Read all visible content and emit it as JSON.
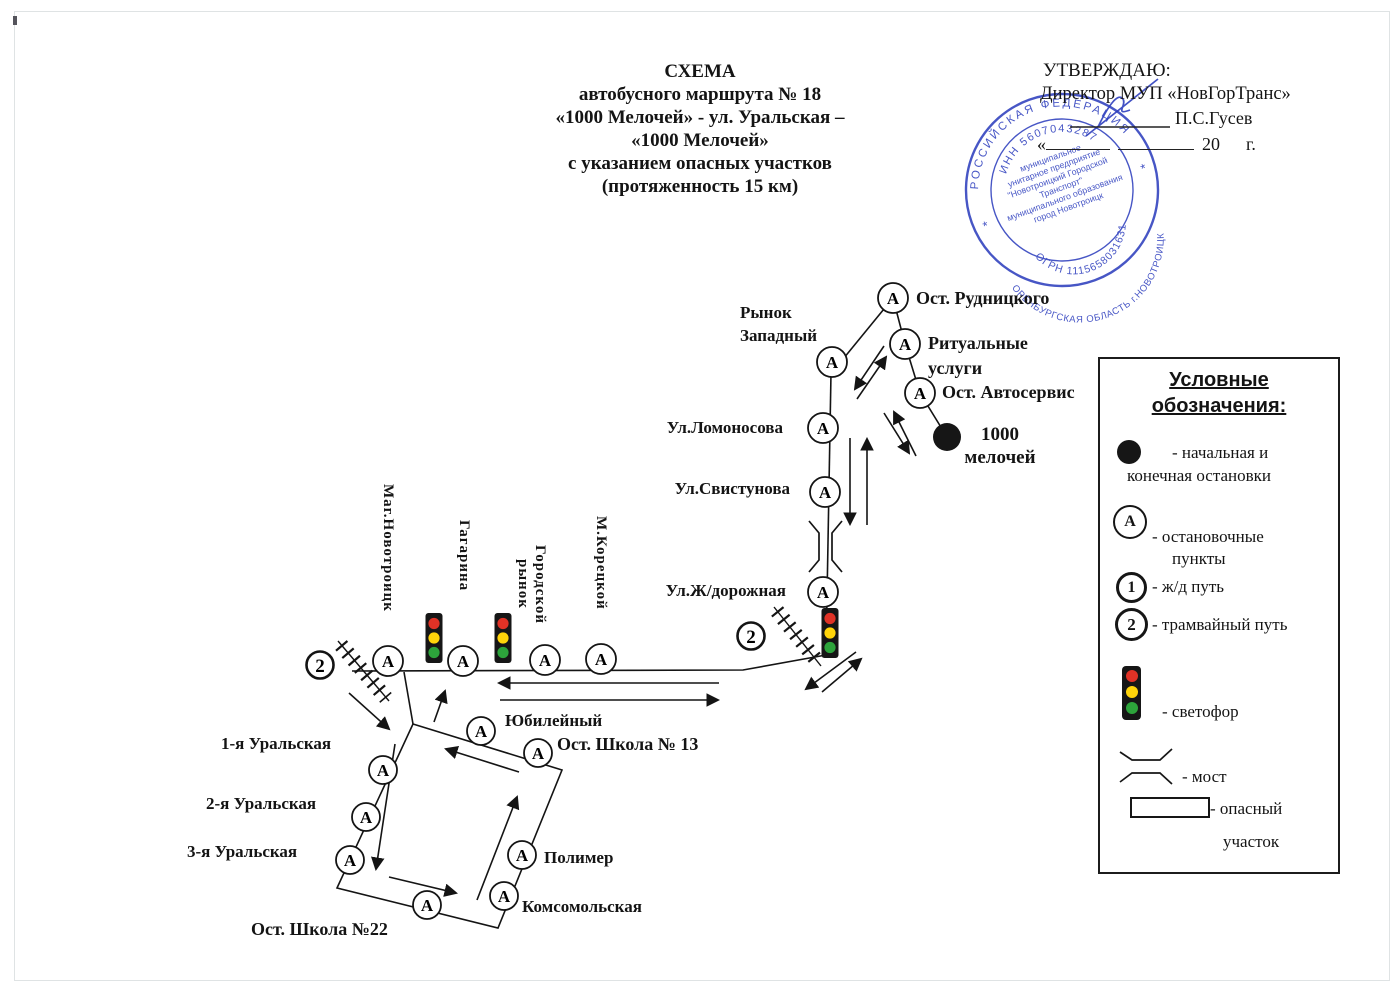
{
  "page": {
    "ink": "#141414",
    "stamp_color": "#2e3fbe"
  },
  "title": {
    "lines": [
      "СХЕМА",
      "автобусного маршрута № 18",
      "«1000 Мелочей» - ул. Уральская –",
      "«1000 Мелочей»",
      "с указанием опасных участков",
      "(протяженность 15 км)"
    ]
  },
  "approve": {
    "heading": "УТВЕРЖДАЮ:",
    "director_line": "Директор  МУП «НовГорТранс»",
    "name": "П.С.Гусев",
    "quote": "«",
    "year": "20",
    "year_unit": "г."
  },
  "stamp": {
    "top_arc": "РОССИЙСКАЯ ФЕДЕРАЦИЯ",
    "inn_arc": "ИНН 5607043287",
    "ogrn_arc": "ОГРН 1115658031631",
    "bottom_arc": "ОРЕНБУРГСКАЯ ОБЛАСТЬ г.НОВОТРОИЦК",
    "star": "*",
    "center_lines": [
      "муниципальное",
      "унитарное предприятие",
      "\"Новотроицкий Городской",
      "Транспорт\"",
      "муниципального образования",
      "город Новотроицк"
    ]
  },
  "map": {
    "stop_letter": "А",
    "tram_marker": "2",
    "labels": {
      "rynok_zapadny_1": "Рынок",
      "rynok_zapadny_2": "Западный",
      "ost_rudnitskogo": "Ост. Рудницкого",
      "ritualnye_1": "Ритуальные",
      "ritualnye_2": "услуги",
      "ost_avtoservis": "Ост. Автосервис",
      "tysyacha_1": "1000",
      "tysyacha_2": "мелочей",
      "lomonosova": "Ул.Ломоносова",
      "svistunova": "Ул.Свистунова",
      "zhd": "Ул.Ж/дорожная",
      "mag_novotroitsk": "Маг.Новотроицк",
      "gagarina": "Гагарина",
      "gor_rynok_1": "Городской",
      "gor_rynok_2": "рынок",
      "koretskoy": "М.Корецкой",
      "yubileyny": "Юбилейный",
      "shkola13": "Ост. Школа № 13",
      "ural1": "1-я Уральская",
      "ural2": "2-я Уральская",
      "ural3": "3-я Уральская",
      "shkola22": "Ост. Школа №22",
      "polimer": "Полимер",
      "komsomolskaya": "Комсомольская"
    }
  },
  "legend": {
    "title_lines": [
      "Условные",
      "обозначения:"
    ],
    "terminal_1": "- начальная и",
    "terminal_2": "конечная остановки",
    "stop_1": "- остановочные",
    "stop_2": "пункты",
    "stop_symbol": "А",
    "rail_symbol": "1",
    "rail_label": "- ж/д путь",
    "tram_symbol": "2",
    "tram_label": "- трамвайный путь",
    "light_label": "- светофор",
    "bridge_label": "- мост",
    "danger_1": "- опасный",
    "danger_2": "участок"
  }
}
